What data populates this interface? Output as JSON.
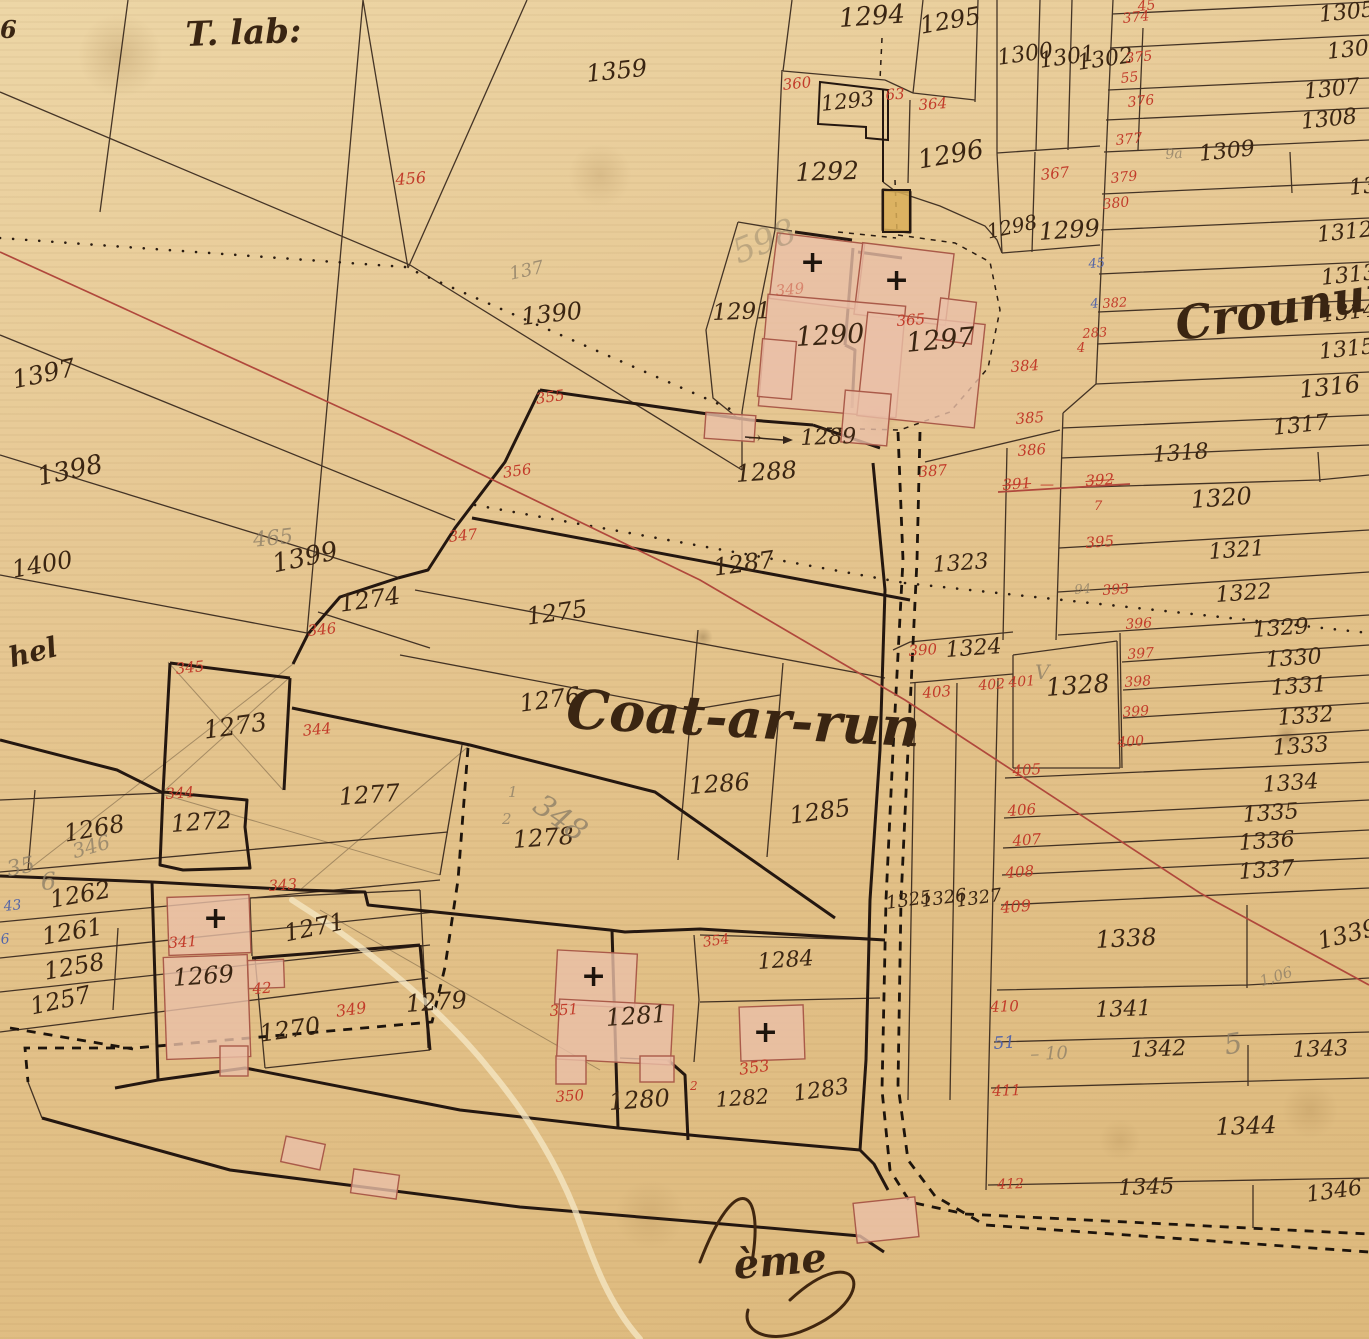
{
  "map": {
    "title": "Coat-ar-run",
    "colors": {
      "paper": "#e5c48f",
      "ink": "#3a2512",
      "red": "#c23b2a",
      "blue": "#5566a8",
      "pencil": "#8f8068",
      "building": "#eabfa8",
      "building_stroke": "#aa5a49",
      "survey_line": "#b0483c"
    },
    "place_names": {
      "top_left": "T. lab:",
      "center": "Coat-ar-run",
      "right_edge": "Croununn",
      "left_edge_fragment": "hel",
      "bottom_fragment": "ème"
    },
    "labels": [
      [
        "1294",
        838,
        6,
        "ink",
        26,
        -4
      ],
      [
        "1295",
        918,
        14,
        "ink",
        24,
        -10
      ],
      [
        "1293",
        820,
        94,
        "ink",
        21,
        -6
      ],
      [
        "1292",
        795,
        160,
        "ink",
        25,
        -2
      ],
      [
        "1296",
        916,
        148,
        "ink",
        26,
        -10
      ],
      [
        "1300",
        996,
        48,
        "ink",
        22,
        -8
      ],
      [
        "1301",
        1038,
        51,
        "ink",
        22,
        -8
      ],
      [
        "1302",
        1076,
        53,
        "ink",
        22,
        -8
      ],
      [
        "1305",
        1318,
        5,
        "ink",
        22,
        -6
      ],
      [
        "1306",
        1326,
        42,
        "ink",
        22,
        -6
      ],
      [
        "1307",
        1303,
        82,
        "ink",
        22,
        -6
      ],
      [
        "1308",
        1300,
        112,
        "ink",
        22,
        -6
      ],
      [
        "1309",
        1198,
        144,
        "ink",
        22,
        -6
      ],
      [
        "1311",
        1348,
        178,
        "ink",
        22,
        -6
      ],
      [
        "1312",
        1316,
        225,
        "ink",
        22,
        -6
      ],
      [
        "1313",
        1320,
        268,
        "ink",
        22,
        -6
      ],
      [
        "1314",
        1320,
        305,
        "ink",
        22,
        -6
      ],
      [
        "1315",
        1318,
        342,
        "ink",
        22,
        -6
      ],
      [
        "1316",
        1298,
        378,
        "ink",
        24,
        -6
      ],
      [
        "1317",
        1272,
        418,
        "ink",
        22,
        -6
      ],
      [
        "1318",
        1152,
        445,
        "ink",
        22,
        -4
      ],
      [
        "1320",
        1190,
        488,
        "ink",
        24,
        -4
      ],
      [
        "1321",
        1208,
        542,
        "ink",
        22,
        -4
      ],
      [
        "1322",
        1215,
        585,
        "ink",
        22,
        -4
      ],
      [
        "1323",
        932,
        555,
        "ink",
        22,
        -4
      ],
      [
        "1324",
        945,
        640,
        "ink",
        22,
        -4
      ],
      [
        "1328",
        1045,
        675,
        "ink",
        25,
        -4
      ],
      [
        "1329",
        1252,
        620,
        "ink",
        22,
        -4
      ],
      [
        "1330",
        1265,
        650,
        "ink",
        22,
        -4
      ],
      [
        "1331",
        1270,
        678,
        "ink",
        22,
        -4
      ],
      [
        "1332",
        1277,
        708,
        "ink",
        22,
        -4
      ],
      [
        "1333",
        1272,
        738,
        "ink",
        22,
        -4
      ],
      [
        "1334",
        1262,
        775,
        "ink",
        22,
        -4
      ],
      [
        "1335",
        1242,
        805,
        "ink",
        22,
        -4
      ],
      [
        "1336",
        1238,
        833,
        "ink",
        22,
        -4
      ],
      [
        "1337",
        1238,
        862,
        "ink",
        22,
        -4
      ],
      [
        "1325",
        885,
        895,
        "ink",
        18,
        -8
      ],
      [
        "1326",
        920,
        893,
        "ink",
        18,
        -8
      ],
      [
        "1327",
        955,
        893,
        "ink",
        18,
        -8
      ],
      [
        "1338",
        1095,
        928,
        "ink",
        24,
        -3
      ],
      [
        "1339",
        1315,
        930,
        "ink",
        24,
        -14
      ],
      [
        "1341",
        1095,
        1000,
        "ink",
        22,
        -2
      ],
      [
        "1342",
        1130,
        1040,
        "ink",
        22,
        -2
      ],
      [
        "1343",
        1292,
        1040,
        "ink",
        22,
        -2
      ],
      [
        "1344",
        1215,
        1115,
        "ink",
        24,
        -2
      ],
      [
        "1345",
        1118,
        1178,
        "ink",
        22,
        -2
      ],
      [
        "1346",
        1305,
        1185,
        "ink",
        22,
        -8
      ],
      [
        "1298",
        985,
        222,
        "ink",
        20,
        -12
      ],
      [
        "1299",
        1038,
        220,
        "ink",
        24,
        -4
      ],
      [
        "1359",
        585,
        62,
        "ink",
        24,
        -6
      ],
      [
        "1390",
        520,
        305,
        "ink",
        24,
        -6
      ],
      [
        "1397",
        10,
        368,
        "ink",
        25,
        -12
      ],
      [
        "1398",
        35,
        465,
        "ink",
        26,
        -12
      ],
      [
        "1400",
        10,
        558,
        "ink",
        24,
        -10
      ],
      [
        "1399",
        270,
        552,
        "ink",
        26,
        -12
      ],
      [
        "1274",
        338,
        592,
        "ink",
        24,
        -8
      ],
      [
        "1275",
        525,
        605,
        "ink",
        24,
        -8
      ],
      [
        "1276",
        518,
        692,
        "ink",
        24,
        -8
      ],
      [
        "1273",
        202,
        718,
        "ink",
        25,
        -8
      ],
      [
        "1277",
        338,
        785,
        "ink",
        24,
        -4
      ],
      [
        "1278",
        512,
        828,
        "ink",
        24,
        -4
      ],
      [
        "1272",
        170,
        812,
        "ink",
        24,
        -4
      ],
      [
        "1268",
        62,
        822,
        "ink",
        24,
        -10
      ],
      [
        "1262",
        48,
        888,
        "ink",
        24,
        -10
      ],
      [
        "1261",
        40,
        925,
        "ink",
        24,
        -10
      ],
      [
        "1258",
        42,
        960,
        "ink",
        24,
        -10
      ],
      [
        "1257",
        28,
        995,
        "ink",
        24,
        -12
      ],
      [
        "1271",
        282,
        922,
        "ink",
        24,
        -12
      ],
      [
        "1269",
        172,
        966,
        "ink",
        24,
        -4
      ],
      [
        "1270",
        258,
        1022,
        "ink",
        24,
        -8
      ],
      [
        "1279",
        405,
        992,
        "ink",
        24,
        -4
      ],
      [
        "1281",
        605,
        1006,
        "ink",
        24,
        -4
      ],
      [
        "1280",
        608,
        1090,
        "ink",
        24,
        -4
      ],
      [
        "1282",
        715,
        1090,
        "ink",
        21,
        -4
      ],
      [
        "1283",
        792,
        1084,
        "ink",
        22,
        -8
      ],
      [
        "1284",
        757,
        952,
        "ink",
        22,
        -4
      ],
      [
        "1285",
        788,
        804,
        "ink",
        24,
        -8
      ],
      [
        "1286",
        688,
        774,
        "ink",
        24,
        -4
      ],
      [
        "1287",
        712,
        556,
        "ink",
        24,
        -8
      ],
      [
        "1288",
        735,
        462,
        "ink",
        24,
        -4
      ],
      [
        "1289",
        800,
        428,
        "ink",
        22,
        -2
      ],
      [
        "→",
        748,
        430,
        "ink",
        16,
        0
      ],
      [
        "1290",
        795,
        324,
        "ink",
        27,
        -3
      ],
      [
        "1297",
        905,
        330,
        "ink",
        27,
        -5
      ],
      [
        "1291",
        712,
        302,
        "ink",
        23,
        -2
      ],
      [
        "456",
        395,
        172,
        "red",
        16,
        -4
      ],
      [
        "360",
        782,
        78,
        "red",
        15,
        -6
      ],
      [
        "63",
        885,
        88,
        "red",
        15,
        -4
      ],
      [
        "364",
        918,
        98,
        "red",
        15,
        -4
      ],
      [
        "45",
        1137,
        0,
        "red",
        14,
        -6
      ],
      [
        "374",
        1122,
        12,
        "red",
        14,
        -6
      ],
      [
        "375",
        1125,
        52,
        "red",
        14,
        -6
      ],
      [
        "55",
        1120,
        72,
        "red",
        14,
        -6
      ],
      [
        "376",
        1127,
        96,
        "red",
        14,
        -6
      ],
      [
        "377",
        1115,
        134,
        "red",
        14,
        -6
      ],
      [
        "379",
        1110,
        172,
        "red",
        14,
        -6
      ],
      [
        "380",
        1102,
        198,
        "red",
        14,
        -6
      ],
      [
        "367",
        1040,
        168,
        "red",
        15,
        -6
      ],
      [
        "384",
        1010,
        360,
        "red",
        15,
        -4
      ],
      [
        "385",
        1015,
        412,
        "red",
        15,
        -4
      ],
      [
        "386",
        1017,
        444,
        "red",
        15,
        -4
      ],
      [
        "391",
        1002,
        478,
        "red struck",
        15,
        -4
      ],
      [
        "—",
        1040,
        478,
        "red",
        14,
        0
      ],
      [
        "392",
        1085,
        474,
        "red struck",
        15,
        -4
      ],
      [
        "7",
        1094,
        500,
        "red",
        13,
        0
      ],
      [
        "395",
        1085,
        536,
        "red",
        15,
        -4
      ],
      [
        "393",
        1102,
        584,
        "red",
        14,
        -4
      ],
      [
        "396",
        1125,
        618,
        "red",
        14,
        -4
      ],
      [
        "397",
        1127,
        648,
        "red",
        14,
        -4
      ],
      [
        "398",
        1124,
        676,
        "red",
        14,
        -4
      ],
      [
        "399",
        1122,
        706,
        "red",
        14,
        -4
      ],
      [
        "400",
        1117,
        736,
        "red",
        14,
        -4
      ],
      [
        "405",
        1012,
        764,
        "red",
        15,
        -4
      ],
      [
        "406",
        1007,
        804,
        "red",
        15,
        -4
      ],
      [
        "407",
        1012,
        834,
        "red",
        15,
        -4
      ],
      [
        "408",
        1005,
        866,
        "red",
        15,
        -4
      ],
      [
        "409",
        1000,
        900,
        "red",
        16,
        -4
      ],
      [
        "390",
        908,
        644,
        "red",
        15,
        -4
      ],
      [
        "403",
        922,
        686,
        "red",
        15,
        -4
      ],
      [
        "402",
        978,
        679,
        "red",
        14,
        -4
      ],
      [
        "401",
        1008,
        676,
        "red",
        14,
        -4
      ],
      [
        "410",
        990,
        1000,
        "red",
        15,
        -2
      ],
      [
        "411",
        992,
        1084,
        "red",
        15,
        -2
      ],
      [
        "412",
        997,
        1178,
        "red",
        14,
        -2
      ],
      [
        "387",
        918,
        465,
        "red",
        15,
        -4
      ],
      [
        "355",
        535,
        392,
        "red",
        15,
        -8
      ],
      [
        "356",
        502,
        466,
        "red",
        15,
        -8
      ],
      [
        "347",
        448,
        530,
        "red",
        15,
        -6
      ],
      [
        "346",
        307,
        624,
        "red",
        15,
        -6
      ],
      [
        "344",
        302,
        724,
        "red",
        15,
        -6
      ],
      [
        "345",
        175,
        662,
        "red",
        15,
        -6
      ],
      [
        "344",
        165,
        787,
        "red",
        15,
        -4
      ],
      [
        "343",
        268,
        879,
        "red",
        15,
        -4
      ],
      [
        "341",
        168,
        936,
        "red",
        15,
        -4
      ],
      [
        "42",
        252,
        982,
        "red",
        15,
        -4
      ],
      [
        "349",
        335,
        1004,
        "red",
        16,
        -8
      ],
      [
        "350",
        555,
        1090,
        "red",
        15,
        -4
      ],
      [
        "351",
        549,
        1004,
        "red",
        15,
        -4
      ],
      [
        "353",
        738,
        1062,
        "red",
        16,
        -8
      ],
      [
        "354",
        702,
        936,
        "red",
        14,
        -8
      ],
      [
        "2",
        690,
        1080,
        "red",
        12,
        0
      ],
      [
        "365",
        896,
        314,
        "red",
        15,
        -4
      ],
      [
        "349",
        775,
        284,
        "red dim",
        15,
        -6
      ],
      [
        "382",
        1102,
        298,
        "red",
        13,
        -4
      ],
      [
        "283",
        1082,
        328,
        "red",
        13,
        -4
      ],
      [
        "4",
        1077,
        342,
        "red",
        13,
        0
      ],
      [
        "43",
        3,
        900,
        "blue",
        14,
        -6
      ],
      [
        "6",
        0,
        933,
        "blue",
        14,
        -6
      ],
      [
        "45",
        1088,
        258,
        "blue",
        13,
        -4
      ],
      [
        "4",
        1090,
        298,
        "blue",
        13,
        -4
      ],
      [
        "51",
        993,
        1036,
        "blue",
        17,
        -4
      ],
      [
        "465",
        252,
        530,
        "pencil",
        21,
        -6
      ],
      [
        "137",
        508,
        266,
        "pencil",
        18,
        -12
      ],
      [
        "35",
        5,
        860,
        "pencil",
        22,
        -12
      ],
      [
        "6",
        40,
        870,
        "pencil",
        24,
        -4
      ],
      [
        "346",
        70,
        842,
        "pencil",
        20,
        -16
      ],
      [
        "94",
        1074,
        584,
        "pencil",
        13,
        -4
      ],
      [
        "– 10",
        1030,
        1046,
        "pencil",
        18,
        -2
      ],
      [
        "5",
        1222,
        1032,
        "pencil",
        28,
        -10
      ],
      [
        "1,06",
        1258,
        975,
        "pencil",
        15,
        -18
      ],
      [
        "V",
        1035,
        662,
        "pencil",
        20,
        0
      ],
      [
        "598",
        728,
        238,
        "pencil dim",
        34,
        -22
      ],
      [
        "1",
        508,
        785,
        "pencil",
        15,
        0
      ],
      [
        "2",
        502,
        812,
        "pencil",
        15,
        0
      ],
      [
        "348",
        545,
        790,
        "pencil",
        30,
        35
      ],
      [
        "9a",
        1165,
        148,
        "pencil",
        14,
        -4
      ],
      [
        "T. lab:",
        185,
        18,
        "cursive",
        34,
        -2
      ],
      [
        "Coat-ar-run",
        568,
        682,
        "cursive",
        54,
        3
      ],
      [
        "Croununn",
        1172,
        302,
        "cursive",
        46,
        -9
      ],
      [
        "hel",
        6,
        645,
        "cursive",
        28,
        -14
      ],
      [
        "ème",
        732,
        1246,
        "cursive",
        40,
        -5
      ],
      [
        "6",
        0,
        18,
        "cursive",
        24,
        0
      ],
      [
        "+",
        800,
        248,
        "cross",
        30,
        0
      ],
      [
        "+",
        884,
        266,
        "cross",
        30,
        0
      ],
      [
        "+",
        581,
        962,
        "cross",
        30,
        0
      ],
      [
        "+",
        753,
        1018,
        "cross",
        30,
        0
      ],
      [
        "+",
        203,
        904,
        "cross",
        30,
        0
      ]
    ]
  }
}
